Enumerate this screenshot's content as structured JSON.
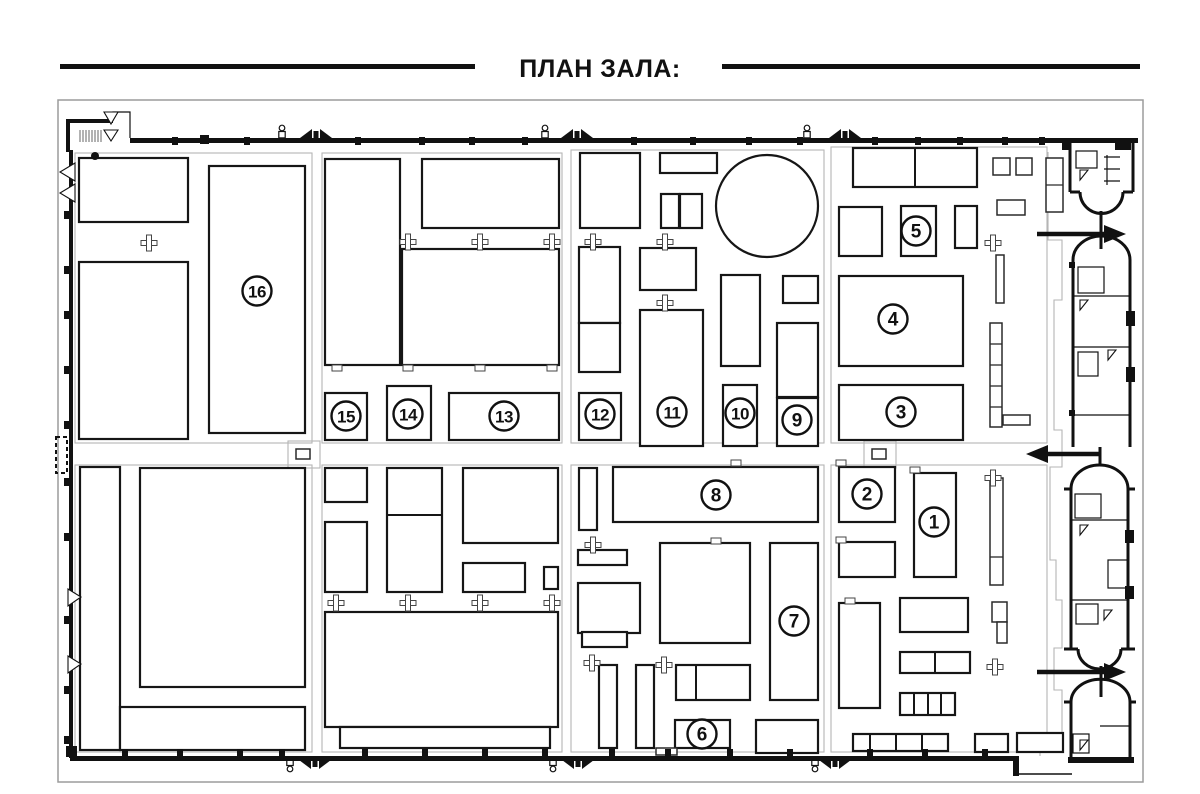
{
  "title": "ПЛАН ЗАЛА:",
  "plan": {
    "booths": [
      {
        "num": "1",
        "x": 934,
        "y": 522
      },
      {
        "num": "2",
        "x": 867,
        "y": 494
      },
      {
        "num": "3",
        "x": 901,
        "y": 412
      },
      {
        "num": "4",
        "x": 893,
        "y": 319
      },
      {
        "num": "5",
        "x": 916,
        "y": 231
      },
      {
        "num": "6",
        "x": 702,
        "y": 734
      },
      {
        "num": "7",
        "x": 794,
        "y": 621
      },
      {
        "num": "8",
        "x": 716,
        "y": 495
      },
      {
        "num": "9",
        "x": 797,
        "y": 420
      },
      {
        "num": "10",
        "x": 740,
        "y": 413
      },
      {
        "num": "11",
        "x": 672,
        "y": 412
      },
      {
        "num": "12",
        "x": 600,
        "y": 414
      },
      {
        "num": "13",
        "x": 504,
        "y": 416
      },
      {
        "num": "14",
        "x": 408,
        "y": 414
      },
      {
        "num": "15",
        "x": 346,
        "y": 416
      },
      {
        "num": "16",
        "x": 257,
        "y": 291
      }
    ],
    "entrance_arrows": [
      {
        "direction": "right",
        "y": 234
      },
      {
        "direction": "left",
        "y": 454
      },
      {
        "direction": "right",
        "y": 672
      }
    ]
  },
  "colors": {
    "ink": "#111111",
    "booth_stroke": "#161616",
    "contour_gray": "#b5b5b5",
    "border_gray": "#9c9c9c",
    "background": "#ffffff"
  }
}
